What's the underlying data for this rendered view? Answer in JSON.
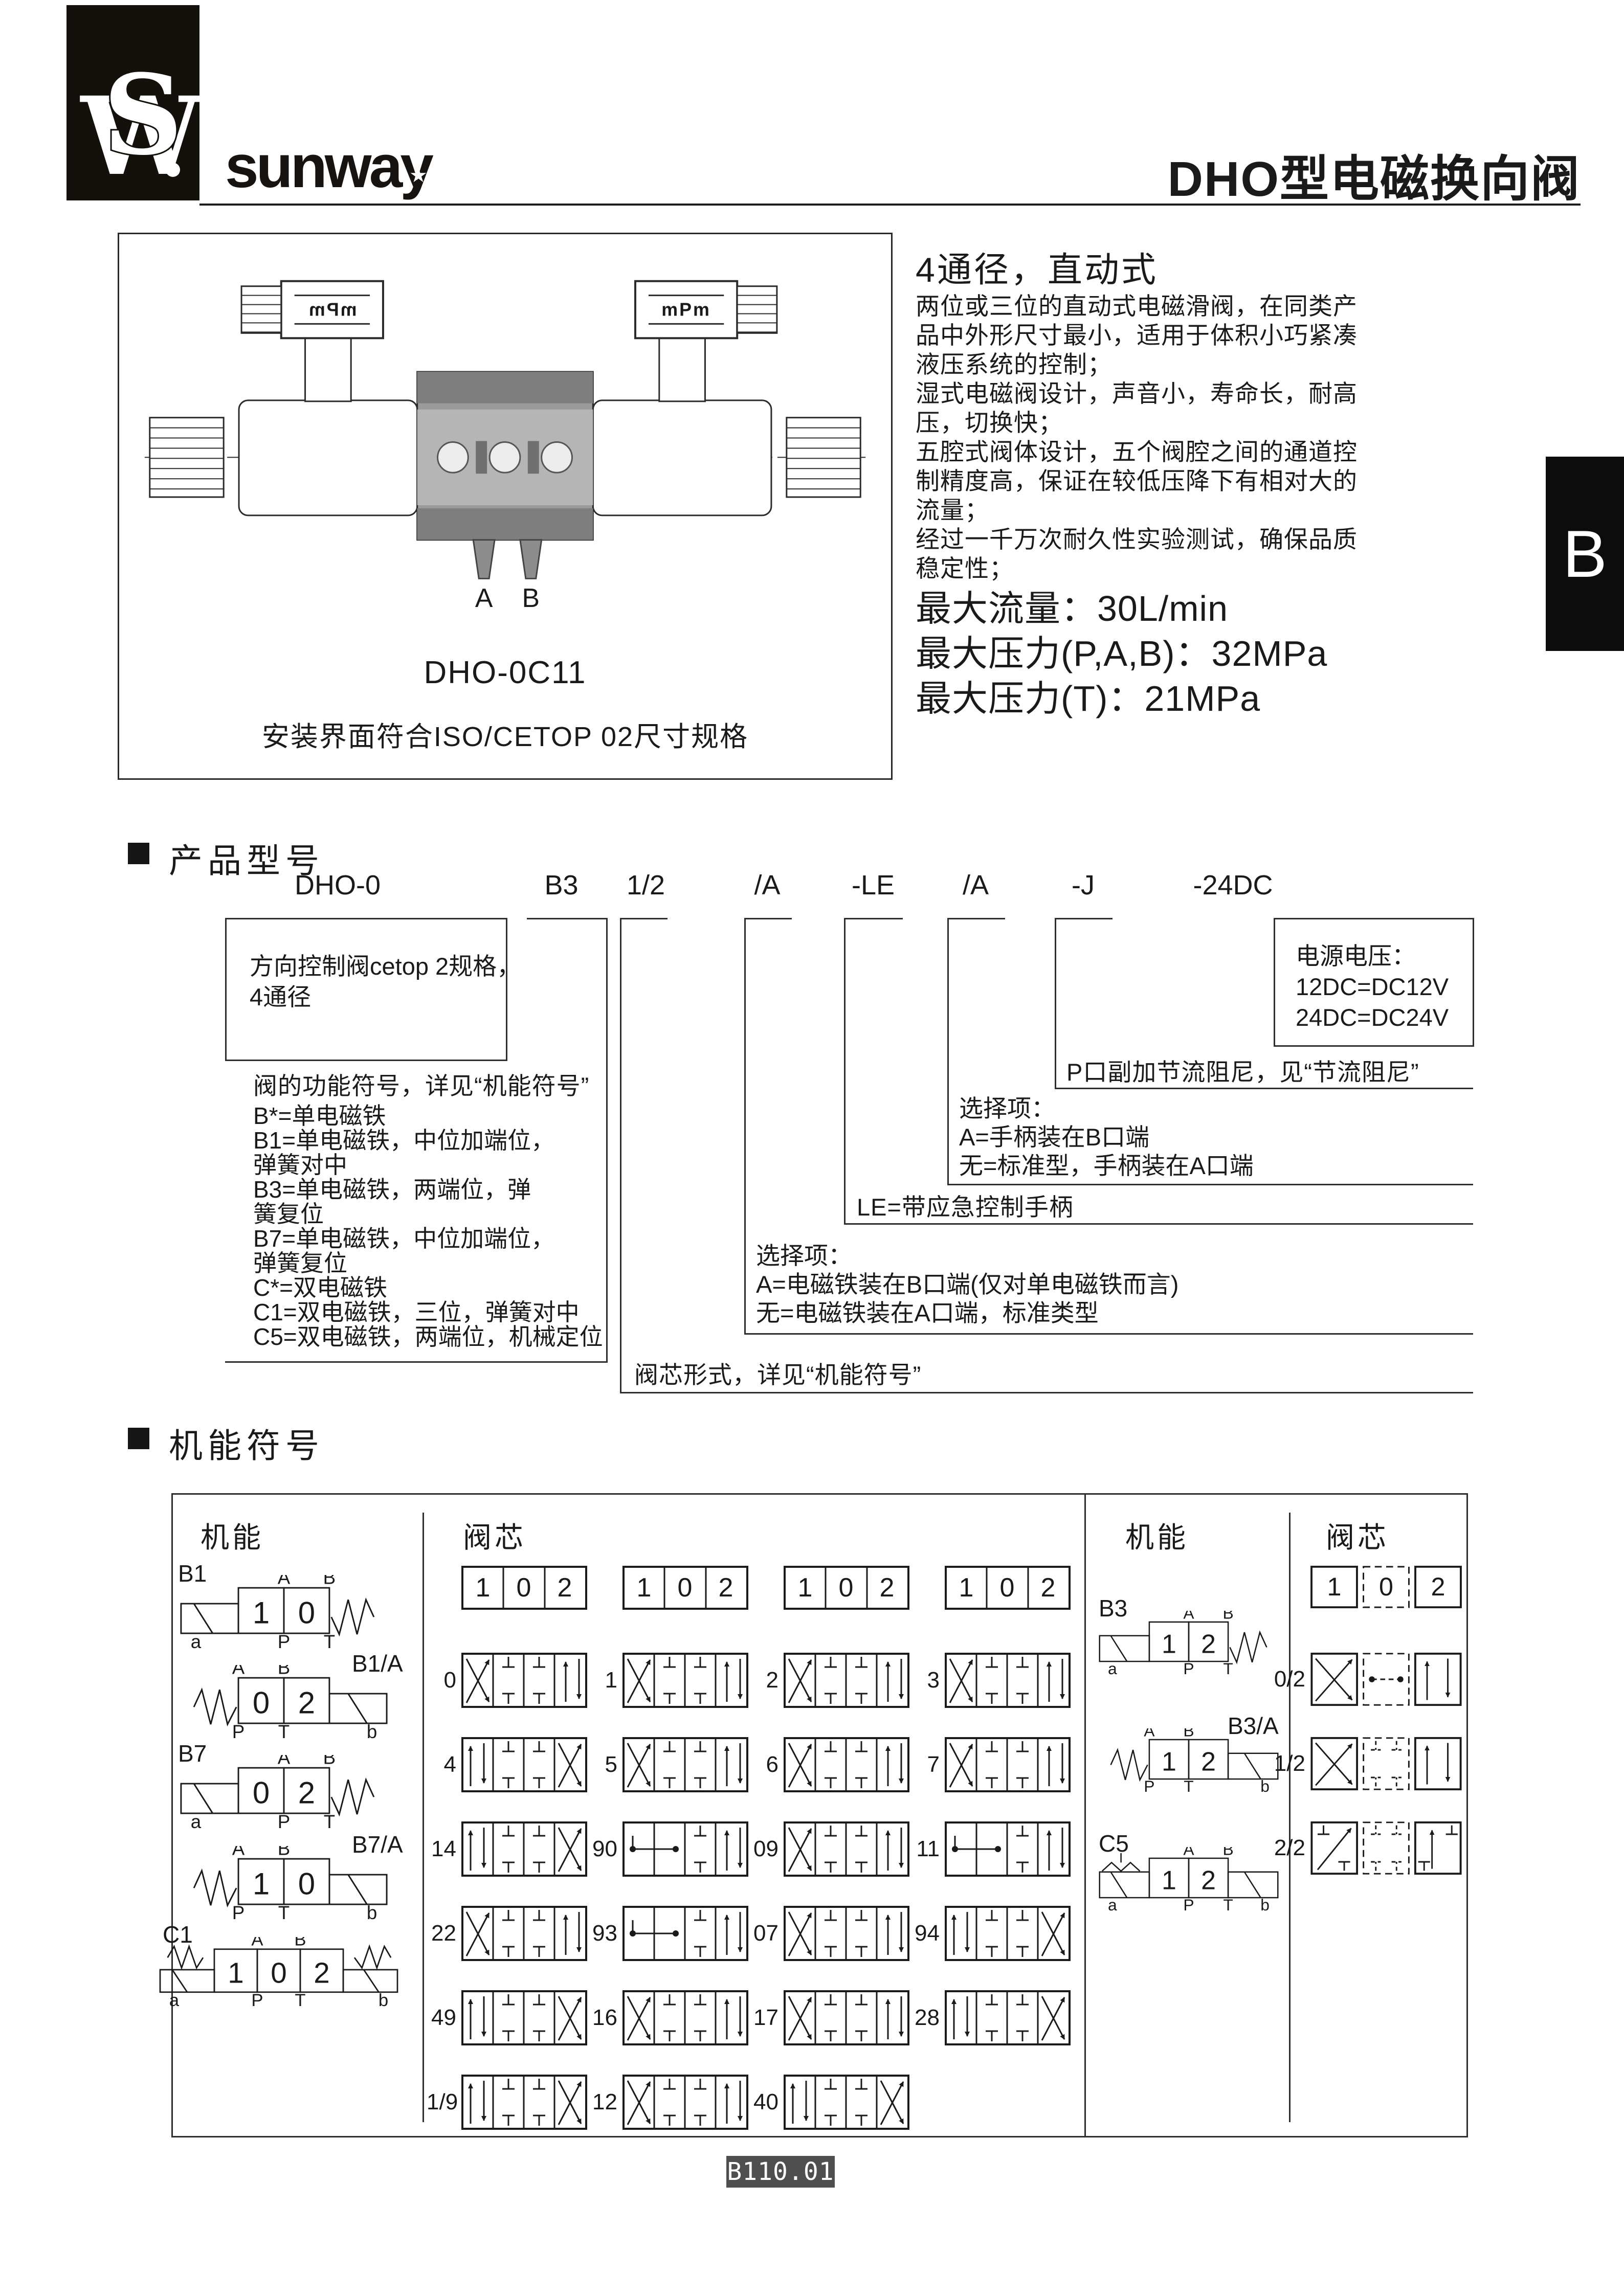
{
  "header": {
    "brand": "sunway",
    "monogram": "WS",
    "title": "DHO型电磁换向阀"
  },
  "side_tab": {
    "label": "B"
  },
  "product_figure": {
    "model": "DHO-0C11",
    "mount_note": "安装界面符合ISO/CETOP 02尺寸规格",
    "connector_left": "mPm",
    "connector_right": "mPm",
    "port_left": "A",
    "port_right": "B"
  },
  "intro": {
    "heading": "4通径，直动式",
    "lines": [
      "两位或三位的直动式电磁滑阀，在同类产",
      "品中外形尺寸最小，适用于体积小巧紧凑",
      "液压系统的控制；",
      "湿式电磁阀设计，声音小，寿命长，耐高",
      "压，切换快；",
      "五腔式阀体设计，五个阀腔之间的通道控",
      "制精度高，保证在较低压降下有相对大的",
      "流量；",
      "经过一千万次耐久性实验测试，确保品质",
      "稳定性；"
    ],
    "specs": [
      "最大流量：30L/min",
      "最大压力(P,A,B)：32MPa",
      "最大压力(T)：21MPa"
    ]
  },
  "model_code": {
    "section_title": "产品型号",
    "codes": [
      "DHO-0",
      "B3",
      "1/2",
      "/A",
      "-LE",
      "/A",
      "-J",
      "-24DC"
    ],
    "series_box": [
      "方向控制阀cetop 2规格，",
      "4通径"
    ],
    "function_note": "阀的功能符号，详见“机能符号”",
    "function_list": [
      "B*=单电磁铁",
      "B1=单电磁铁，中位加端位，",
      "弹簧对中",
      "B3=单电磁铁，两端位，弹",
      "簧复位",
      "B7=单电磁铁，中位加端位，",
      "弹簧复位",
      "C*=双电磁铁",
      "C1=双电磁铁，三位，弹簧对中",
      "C5=双电磁铁，两端位，机械定位"
    ],
    "spool_note": "阀芯形式，详见“机能符号”",
    "solenoid_option": [
      "选择项：",
      "A=电磁铁装在B口端(仅对单电磁铁而言)",
      "无=电磁铁装在A口端，标准类型"
    ],
    "lever_note": "LE=带应急控制手柄",
    "handle_option": [
      "选择项：",
      "A=手柄装在B口端",
      "无=标准型，手柄装在A口端"
    ],
    "damping_note": "P口副加节流阻尼，见“节流阻尼”",
    "voltage_box": [
      "电源电压：",
      "12DC=DC12V",
      "24DC=DC24V"
    ]
  },
  "symbols": {
    "section_title": "机能符号",
    "headers": {
      "left_func": "机能",
      "left_spool": "阀芯",
      "right_func": "机能",
      "right_spool": "阀芯"
    },
    "spool_header": [
      "1",
      "0",
      "2"
    ],
    "left_functions": [
      {
        "tag": "B1",
        "boxes": [
          "1",
          "0"
        ],
        "left": "sol",
        "right": "spr",
        "top": [
          "A",
          "B"
        ],
        "bottom": [
          "P",
          "T"
        ],
        "a": "a",
        "b": null,
        "tag_side": "left"
      },
      {
        "tag": "B1/A",
        "boxes": [
          "0",
          "2"
        ],
        "left": "spr",
        "right": "sol",
        "top": [
          "A",
          "B"
        ],
        "bottom": [
          "P",
          "T"
        ],
        "a": null,
        "b": "b",
        "tag_side": "right"
      },
      {
        "tag": "B7",
        "boxes": [
          "0",
          "2"
        ],
        "left": "sol",
        "right": "spr",
        "top": [
          "A",
          "B"
        ],
        "bottom": [
          "P",
          "T"
        ],
        "a": "a",
        "b": null,
        "tag_side": "left"
      },
      {
        "tag": "B7/A",
        "boxes": [
          "1",
          "0"
        ],
        "left": "spr",
        "right": "sol",
        "top": [
          "A",
          "B"
        ],
        "bottom": [
          "P",
          "T"
        ],
        "a": null,
        "b": "b",
        "tag_side": "right"
      },
      {
        "tag": "C1",
        "boxes": [
          "1",
          "0",
          "2"
        ],
        "left": "sprsol",
        "right": "solspr",
        "top": [
          "A",
          "B"
        ],
        "bottom": [
          "P",
          "T"
        ],
        "a": "a",
        "b": "b",
        "tag_side": "left"
      }
    ],
    "middle_spools": [
      [
        {
          "label": "0",
          "v": "xl"
        },
        {
          "label": "1",
          "v": "xl"
        },
        {
          "label": "2",
          "v": "xl"
        },
        {
          "label": "3",
          "v": "xl"
        }
      ],
      [
        {
          "label": "4",
          "v": "xr"
        },
        {
          "label": "5",
          "v": "xl"
        },
        {
          "label": "6",
          "v": "xl"
        },
        {
          "label": "7",
          "v": "xl"
        }
      ],
      [
        {
          "label": "14",
          "v": "xr"
        },
        {
          "label": "90",
          "v": "do"
        },
        {
          "label": "09",
          "v": "xl"
        },
        {
          "label": "11",
          "v": "do"
        }
      ],
      [
        {
          "label": "22",
          "v": "xl"
        },
        {
          "label": "93",
          "v": "do"
        },
        {
          "label": "07",
          "v": "xl"
        },
        {
          "label": "94",
          "v": "xr"
        }
      ],
      [
        {
          "label": "49",
          "v": "xr"
        },
        {
          "label": "16",
          "v": "xl"
        },
        {
          "label": "17",
          "v": "xl"
        },
        {
          "label": "28",
          "v": "xr"
        }
      ],
      [
        {
          "label": "1/9",
          "v": "xr"
        },
        {
          "label": "12",
          "v": "xl"
        },
        {
          "label": "40",
          "v": "xr"
        }
      ]
    ],
    "right_functions": [
      {
        "tag": "B3",
        "boxes": [
          "1",
          "2"
        ],
        "left": "sol",
        "right": "spr",
        "top": [
          "A",
          "B"
        ],
        "bottom": [
          "P",
          "T"
        ],
        "a": "a",
        "b": null,
        "tag_side": "left"
      },
      {
        "tag": "B3/A",
        "boxes": [
          "1",
          "2"
        ],
        "left": "spr",
        "right": "sol",
        "top": [
          "A",
          "B"
        ],
        "bottom": [
          "P",
          "T"
        ],
        "a": null,
        "b": "b",
        "tag_side": "right"
      },
      {
        "tag": "C5",
        "boxes": [
          "1",
          "2"
        ],
        "left": "soldet",
        "right": "sol",
        "top": [
          "A",
          "B"
        ],
        "bottom": [
          "P",
          "T"
        ],
        "a": "a",
        "b": "b",
        "tag_side": "left"
      }
    ],
    "right_spools": [
      {
        "label": "0/2",
        "v": "r0"
      },
      {
        "label": "1/2",
        "v": "r1"
      },
      {
        "label": "2/2",
        "v": "r2"
      }
    ]
  },
  "footer": {
    "page_code": "B110.01"
  }
}
